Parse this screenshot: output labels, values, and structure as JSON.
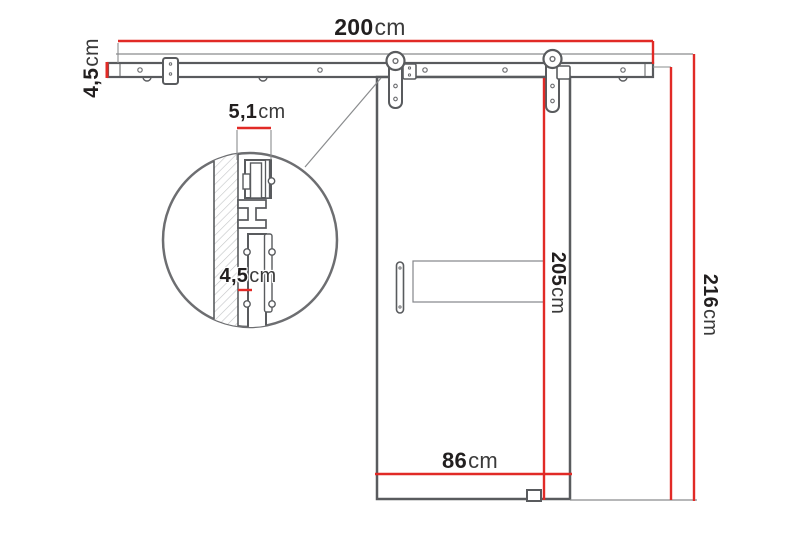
{
  "diagram": {
    "dimensions": {
      "rail_width": {
        "num": "200",
        "unit": "cm"
      },
      "rail_height": {
        "num": "4,5",
        "unit": "cm"
      },
      "wall_clearance": {
        "num": "5,1",
        "unit": "cm"
      },
      "door_thickness": {
        "num": "4,5",
        "unit": "cm"
      },
      "door_height": {
        "num": "205",
        "unit": "cm"
      },
      "door_width": {
        "num": "86",
        "unit": "cm"
      },
      "height_below_rail a.k.a. rail_underside_to_floor": {
        "num": "211",
        "unit": "cm"
      },
      "total_height": {
        "num": "216",
        "unit": "cm"
      }
    },
    "colors": {
      "dimension_red": "#e12a26",
      "line_dark": "#595b5e",
      "line_light": "#8a8c8e"
    }
  }
}
